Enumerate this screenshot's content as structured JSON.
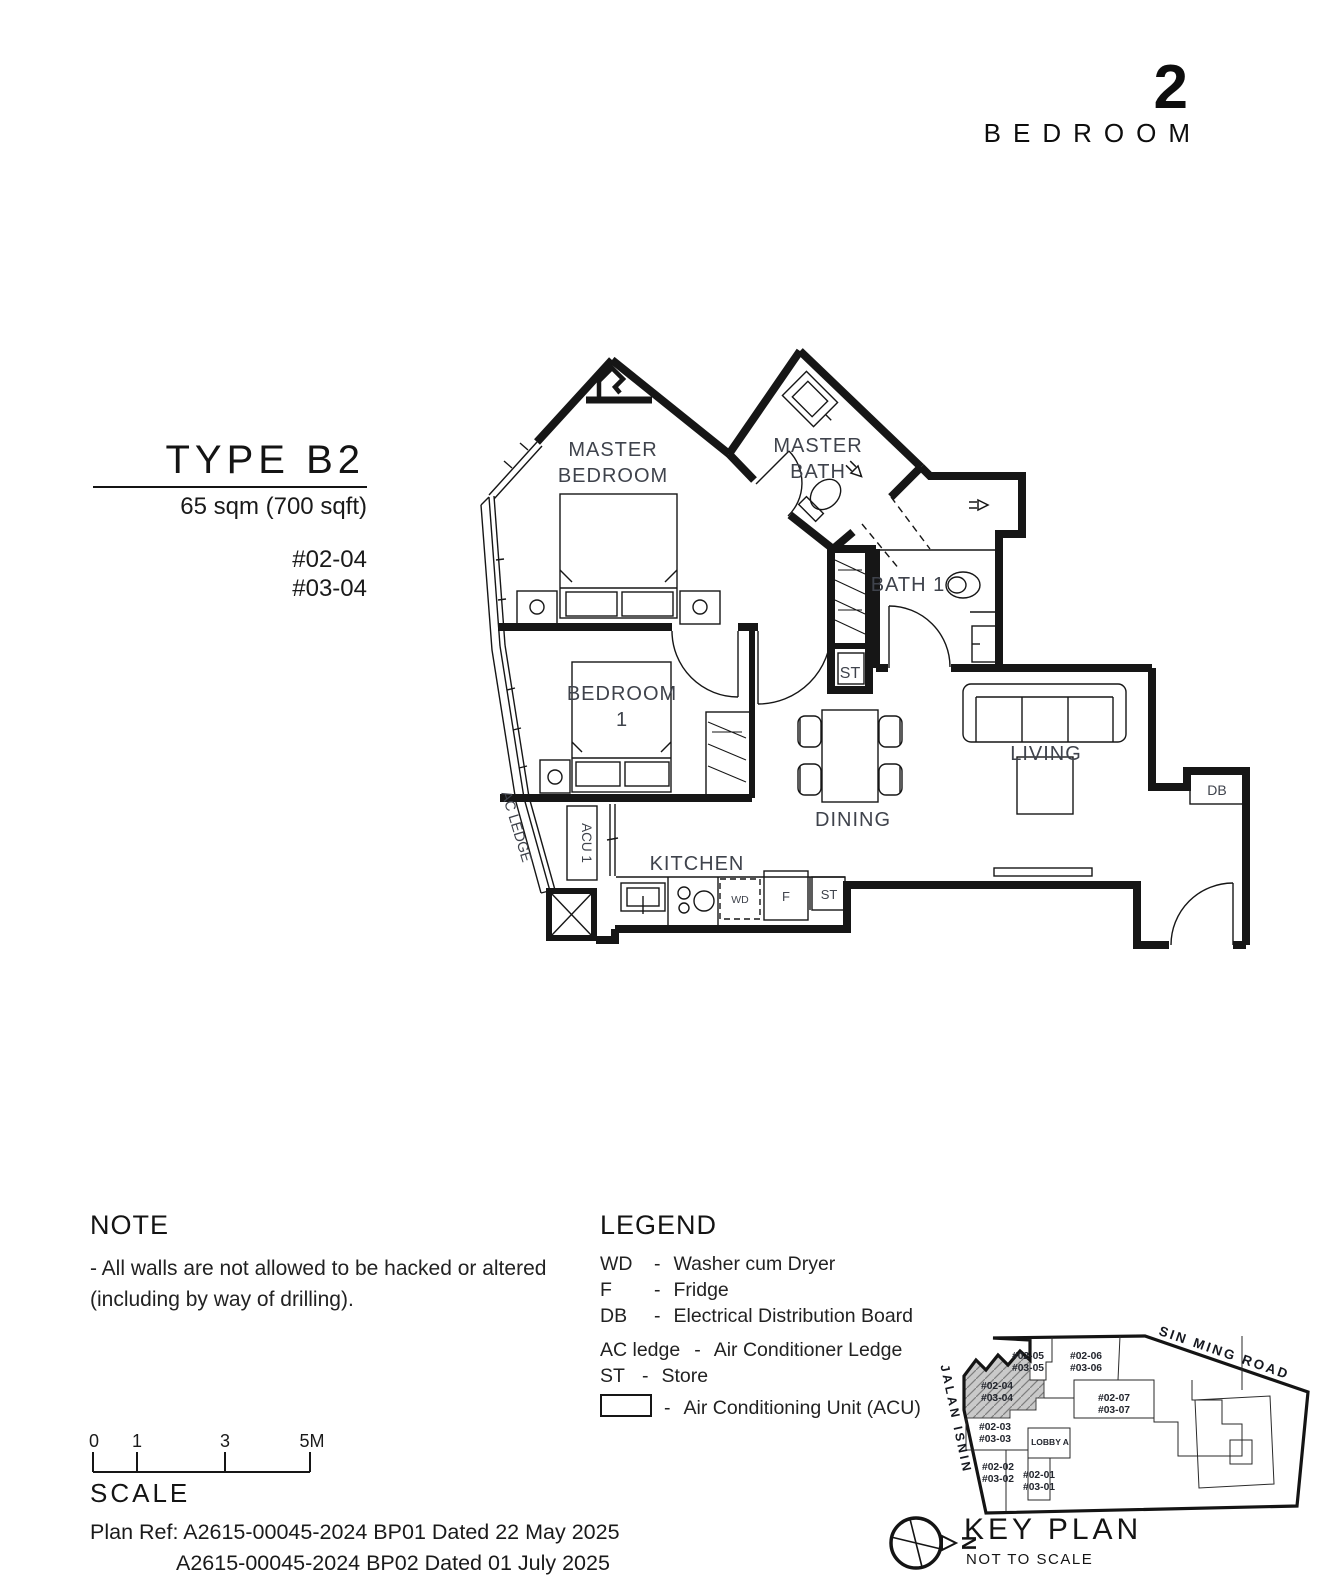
{
  "header": {
    "number": "2",
    "word": "BEDROOM"
  },
  "title_block": {
    "type_label": "TYPE B2",
    "area": "65 sqm (700 sqft)",
    "units": [
      "#02-04",
      "#03-04"
    ]
  },
  "plan": {
    "rooms": {
      "master_bedroom": [
        "MASTER",
        "BEDROOM"
      ],
      "master_bath": [
        "MASTER",
        "BATH"
      ],
      "bedroom1": [
        "BEDROOM",
        "1"
      ],
      "bath1": "BATH 1",
      "living": "LIVING",
      "dining": "DINING",
      "kitchen": "KITCHEN"
    },
    "tags": {
      "st_hall": "ST",
      "st_kitchen": "ST",
      "acu": "ACU 1",
      "ac_ledge": "AC LEDGE",
      "db": "DB",
      "wd": "WD",
      "fridge": "F"
    }
  },
  "note": {
    "heading": "NOTE",
    "lines": [
      "-  All walls are not allowed to be hacked or altered",
      "(including by way of drilling)."
    ]
  },
  "legend": {
    "heading": "LEGEND",
    "separator": "-",
    "rows": [
      {
        "key": "WD",
        "desc": "Washer cum Dryer"
      },
      {
        "key": "F",
        "desc": "Fridge"
      },
      {
        "key": "DB",
        "desc": "Electrical Distribution Board"
      },
      {
        "key": "AC ledge",
        "desc": "Air Conditioner Ledge"
      },
      {
        "key": "ST",
        "desc": "Store"
      }
    ],
    "acu_row": {
      "desc": "Air Conditioning Unit (ACU)"
    }
  },
  "scale_bar": {
    "heading": "SCALE",
    "ticks": [
      "0",
      "1",
      "3",
      "5M"
    ]
  },
  "plan_ref": {
    "lines": [
      "Plan Ref: A2615-00045-2024 BP01 Dated 22 May 2025",
      "A2615-00045-2024 BP02 Dated 01 July 2025"
    ]
  },
  "key_plan": {
    "heading": "KEY PLAN",
    "note": "NOT TO SCALE",
    "north": "N",
    "roads": {
      "sin_ming": "SIN MING ROAD",
      "jalan_isnin": "JALAN ISNIN"
    },
    "lobby": "LOBBY A",
    "highlighted_unit": {
      "lines": [
        "#02-04",
        "#03-04"
      ]
    },
    "units": [
      {
        "lines": [
          "#02-05",
          "#03-05"
        ]
      },
      {
        "lines": [
          "#02-06",
          "#03-06"
        ]
      },
      {
        "lines": [
          "#02-07",
          "#03-07"
        ]
      },
      {
        "lines": [
          "#02-03",
          "#03-03"
        ]
      },
      {
        "lines": [
          "#02-02",
          "#03-02"
        ]
      },
      {
        "lines": [
          "#02-01",
          "#03-01"
        ]
      }
    ]
  },
  "colors": {
    "ink": "#161616",
    "label": "#3f434c",
    "highlight": "#c9c9c9"
  }
}
